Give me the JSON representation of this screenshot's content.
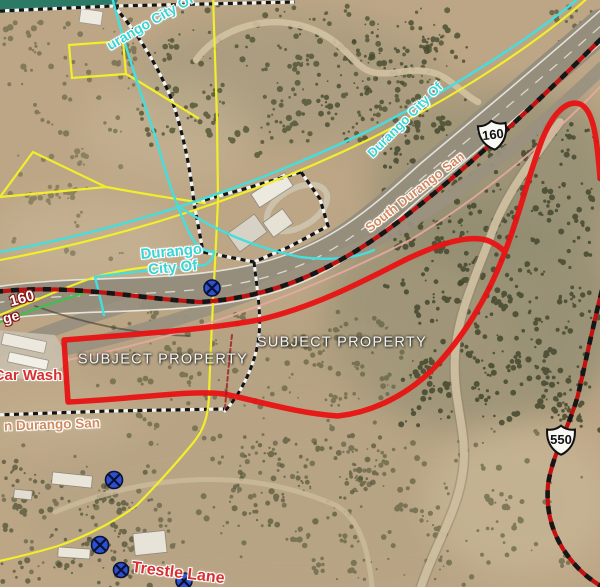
{
  "map": {
    "labels": {
      "subject_property_left": "SUBJECT PROPERTY",
      "subject_property_right": "SUBJECT PROPERTY",
      "city_boundary_top_left": "urango City Of",
      "city_center_line1": "Durango",
      "city_center_line2": "City Of",
      "city_along_highway": "Durango City Of",
      "road_south_durango": "South Durango San",
      "road_n_durango": "n Durango San",
      "poi_car_wash": "Car Wash",
      "road_trestle_lane": "Trestle Lane",
      "road_160_fragment": "160",
      "road_frontage_fragment": "ge"
    },
    "shields": {
      "us_160": "160",
      "us_550": "550"
    },
    "legend_colors": {
      "subject_property_outline": "#e81313",
      "city_boundary_line": "#45dede",
      "parcel_line": "#f2ee2a",
      "railroad_line": "#cc1111",
      "city_limit_dashed": "#111111",
      "road_name_text": "#cf8a60",
      "utility_marker": "#2b50d0"
    }
  }
}
